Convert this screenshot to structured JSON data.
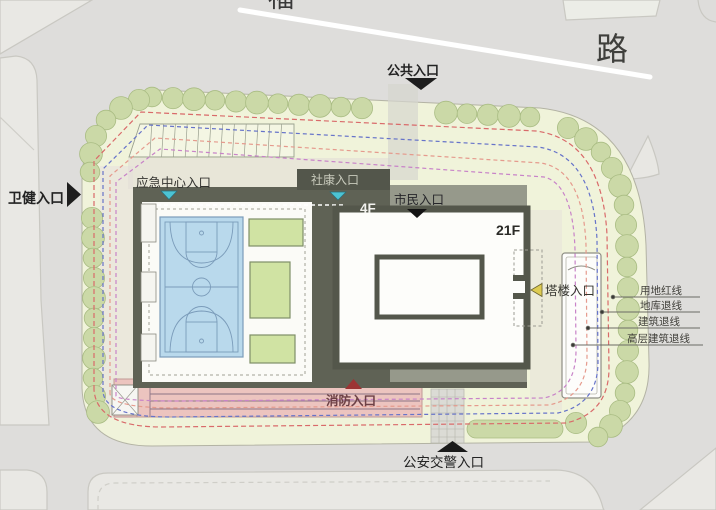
{
  "road": {
    "label": "路",
    "partial_char": "福"
  },
  "entrances": {
    "public": {
      "label": "公共入口"
    },
    "health": {
      "label": "卫健入口"
    },
    "emergency_center": {
      "label": "应急中心入口"
    },
    "community_clinic": {
      "label": "社康入口"
    },
    "citizen": {
      "label": "市民入口"
    },
    "tower": {
      "label": "塔楼入口"
    },
    "fire": {
      "label": "消防入口"
    },
    "police_traffic": {
      "label": "公安交警入口"
    }
  },
  "buildings": {
    "podium_floors": "4F",
    "tower_floors": "21F"
  },
  "legend": {
    "items": [
      {
        "label": "用地红线",
        "color": "#d96a6a"
      },
      {
        "label": "地库退线",
        "color": "#6673c9"
      },
      {
        "label": "建筑退线",
        "color": "#e59a8d"
      },
      {
        "label": "高层建筑退线",
        "color": "#c883c8"
      }
    ]
  },
  "colors": {
    "road": "#dedddb",
    "block": "#e9e8e4",
    "site_fill": "#f0f3da",
    "tree": "#cbd9a7",
    "tree_stroke": "#a9bc83",
    "red_line": "#d96a6a",
    "blue_line": "#6673c9",
    "setback_line": "#e59a8d",
    "highrise_line": "#c883c8",
    "podium_dark": "#5f6255",
    "deck": "#96998b",
    "banner_dark": "#53564b",
    "court": "#b9d9ec",
    "court_line": "#7b9cba",
    "green_roof": "#d0e3a3",
    "fire_lane": "#ecc4bf",
    "teal": "#4cc3d4",
    "tower_border": "#54574b",
    "yellow": "#ddcb52",
    "dark_red": "#9c3434"
  }
}
